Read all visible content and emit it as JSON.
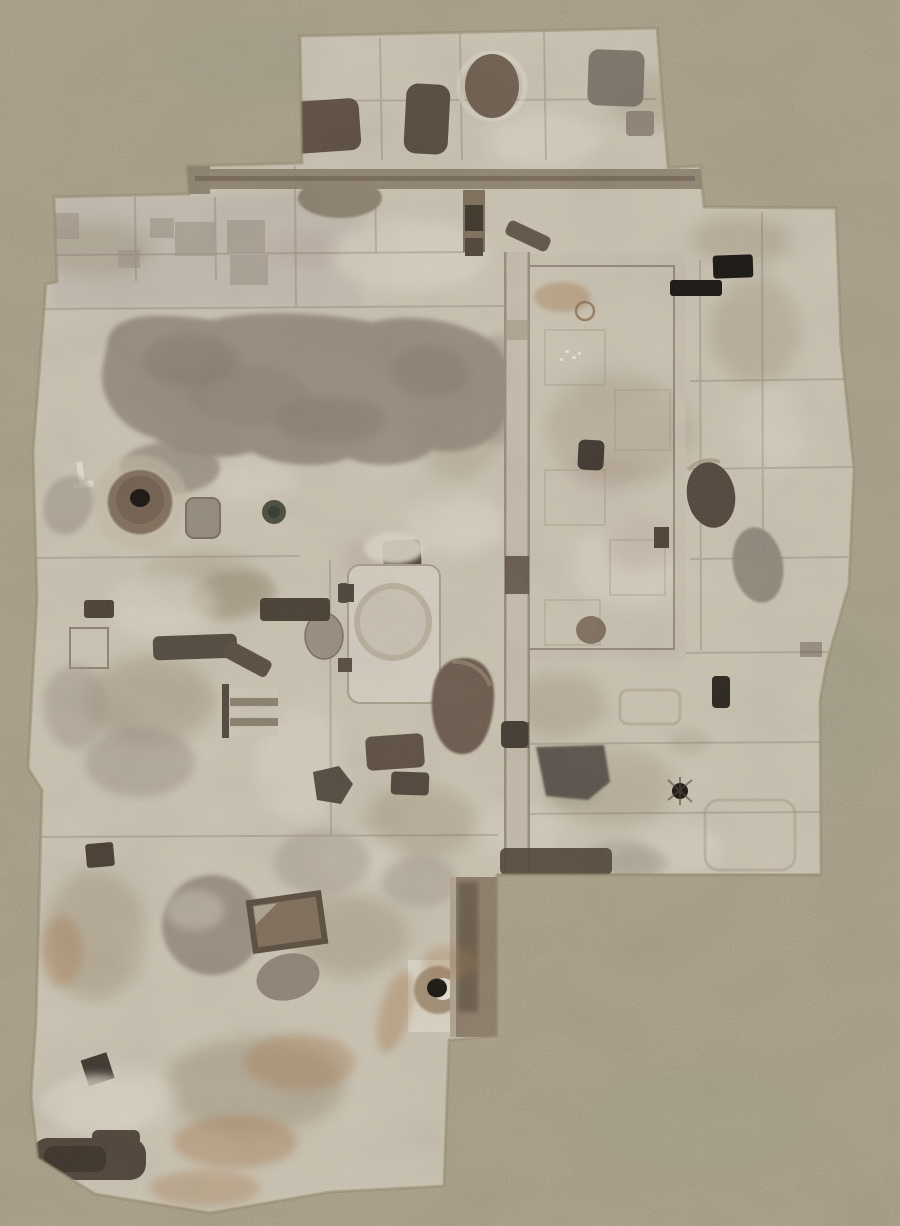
{
  "meta": {
    "title": "Archaeological excavation site - aerial orthophoto",
    "description": "Top-down drone orthophoto of an archaeological excavation: an irregular, stepped excavation area of pale compacted earth divided into unit squares, cut by trenches, baulks, rectangular pits, circular crater pits with dark central holes, a walled rectangular enclosure, rust-stained soil and grey depressions, all surrounded by undisturbed speckled sandy ground. No text, labels or UI elements are visible.",
    "visible_text": "none"
  },
  "palette": {
    "ground": "#aba188",
    "exc": "#cbc3b1",
    "pale": "#ded7c8",
    "mottle": "#a2957d",
    "blob": "#968b7d",
    "trench": "#8c7f6c",
    "line": "#6f6254",
    "baulk": "#c6bcab",
    "wall": "#c8bfad",
    "pitBrown": "#6b5948",
    "pitDark": "#4a3e31",
    "pitBlack": "#120e09",
    "olive": "#47493a",
    "rust": "#a87e52",
    "white": "#eae4d6",
    "grayMound": "#a49a8c",
    "green": "#969c83",
    "pink": "#b3978f"
  },
  "scene": {
    "background": "undisturbed sandy ground with fine dark speckle and faint green tinges",
    "features": [
      {
        "name": "top-excavation-block",
        "description": "upper excavated block with four dark pits and a jar-shaped cut"
      },
      {
        "name": "east-west-trench",
        "description": "long horizontal trench with a sagging dip below the top block"
      },
      {
        "name": "excavation-grid",
        "description": "faint joints between square excavation units"
      },
      {
        "name": "large-gray-depression",
        "description": "large irregular grey-brown depression in the upper left quadrant"
      },
      {
        "name": "crater-pit",
        "description": "round crater with near-black central hole, left side"
      },
      {
        "name": "olive-pit",
        "description": "small dark olive circular pit right of the crater"
      },
      {
        "name": "rect-enclosure",
        "description": "large rectangular walled enclosure with rust stain and inner pit"
      },
      {
        "name": "north-south-baulk",
        "description": "long vertical baulk with dark gaps running down the centre"
      },
      {
        "name": "black-pits",
        "description": "two jet-black rectangular pits in the right column"
      },
      {
        "name": "right-column-pits",
        "description": "dark brown crater and grey hollow along the eastern units"
      },
      {
        "name": "central-room",
        "description": "pale rectangular room with faint circular hearth mark"
      },
      {
        "name": "teardrop-pit",
        "description": "brown teardrop-shaped pit in the centre"
      },
      {
        "name": "big-dark-pit",
        "description": "large dark trapezoidal pit below the enclosure"
      },
      {
        "name": "step-trench",
        "description": "small ladder-like stepped feature"
      },
      {
        "name": "dark-pit-cluster",
        "description": "cluster of dark rectangular pits mid-left and centre"
      },
      {
        "name": "grave-cut",
        "description": "tilted rectangular cut with dark rim, lower left"
      },
      {
        "name": "round-mound",
        "description": "large round grey mound, lower left"
      },
      {
        "name": "well-hole",
        "description": "small black hole with bright white rim inside a pale unit"
      },
      {
        "name": "rust-stains",
        "description": "orange-brown mineral staining near the bottom"
      },
      {
        "name": "bottom-dark-pit",
        "description": "dark rounded rectangular pit at the bottom left corner"
      },
      {
        "name": "east-step",
        "description": "stepped south-east corner where excavation meets unexcavated ground"
      }
    ]
  }
}
